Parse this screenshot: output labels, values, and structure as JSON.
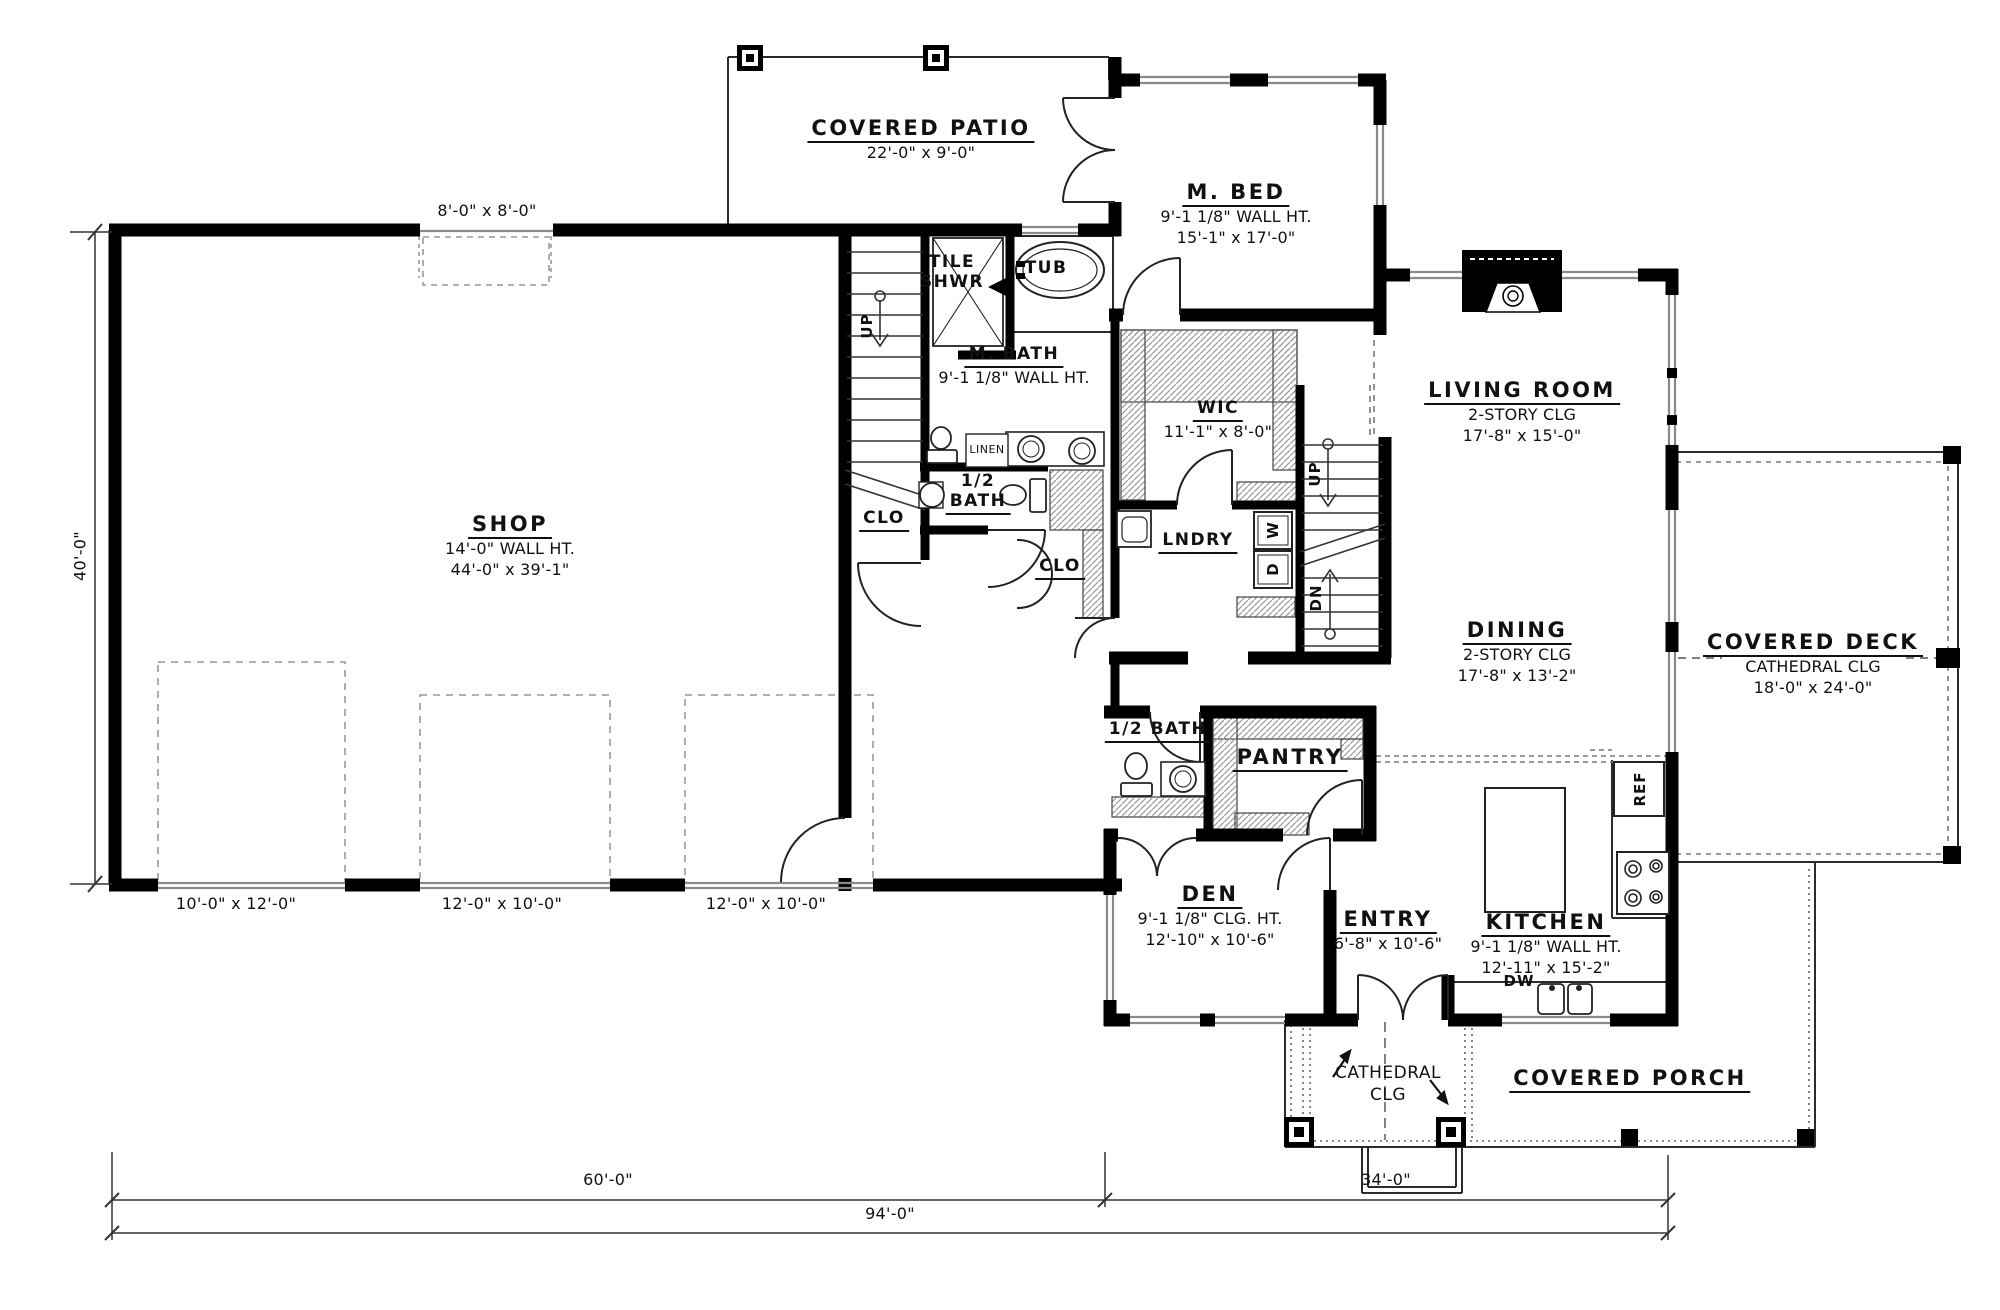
{
  "plan": {
    "rooms": {
      "covered_patio": {
        "title": "COVERED PATIO",
        "dim": "22'-0\" x 9'-0\""
      },
      "m_bed": {
        "title": "M. BED",
        "sub": "9'-1 1/8\" WALL HT.",
        "dim": "15'-1\" x 17'-0\""
      },
      "shop": {
        "title": "SHOP",
        "sub": "14'-0\" WALL HT.",
        "dim": "44'-0\" x 39'-1\""
      },
      "m_bath": {
        "title": "M. BATH",
        "sub": "9'-1 1/8\" WALL HT."
      },
      "tile_shwr": {
        "line1": "TILE",
        "line2": "SHWR"
      },
      "tub": {
        "title": "TUB"
      },
      "wic": {
        "title": "WIC",
        "dim": "11'-1\" x 8'-0\""
      },
      "living_room": {
        "title": "LIVING ROOM",
        "sub": "2-STORY CLG",
        "dim": "17'-8\" x 15'-0\""
      },
      "dining": {
        "title": "DINING",
        "sub": "2-STORY CLG",
        "dim": "17'-8\" x 13'-2\""
      },
      "covered_deck": {
        "title": "COVERED DECK",
        "sub": "CATHEDRAL CLG",
        "dim": "18'-0\" x 24'-0\""
      },
      "lndry": {
        "title": "LNDRY"
      },
      "clo_under_stairs": {
        "title": "CLO"
      },
      "clo_hall": {
        "title": "CLO"
      },
      "linen": {
        "title": "LINEN"
      },
      "half_bath_upper": {
        "line1": "1/2",
        "line2": "BATH"
      },
      "half_bath_lower": {
        "title": "1/2 BATH"
      },
      "pantry": {
        "title": "PANTRY"
      },
      "den": {
        "title": "DEN",
        "sub": "9'-1 1/8\" CLG. HT.",
        "dim": "12'-10\" x 10'-6\""
      },
      "entry": {
        "title": "ENTRY",
        "dim": "6'-8\" x 10'-6\""
      },
      "kitchen": {
        "title": "KITCHEN",
        "sub": "9'-1 1/8\" WALL HT.",
        "dim": "12'-11\" x 15'-2\""
      },
      "covered_porch": {
        "title": "COVERED PORCH"
      }
    },
    "annotations": {
      "cathedral_line1": "CATHEDRAL",
      "cathedral_line2": "CLG",
      "up_left": "UP",
      "up_right": "UP",
      "dn": "DN",
      "washer": "W",
      "dryer": "D",
      "ref": "REF",
      "dw": "DW"
    },
    "dimensions": {
      "overall_width": "94'-0\"",
      "shop_width": "60'-0\"",
      "house_width": "34'-0\"",
      "shop_height": "40'-0\"",
      "shop_rear_door": "8'-0\" x 8'-0\"",
      "garage_door_1": "10'-0\" x 12'-0\"",
      "garage_door_2": "12'-0\" x 10'-0\"",
      "garage_door_3": "12'-0\" x 10'-0\""
    },
    "colors": {
      "ink": "#111111",
      "wall": "#000000",
      "window": "#8a8a8a",
      "background": "#ffffff"
    }
  }
}
